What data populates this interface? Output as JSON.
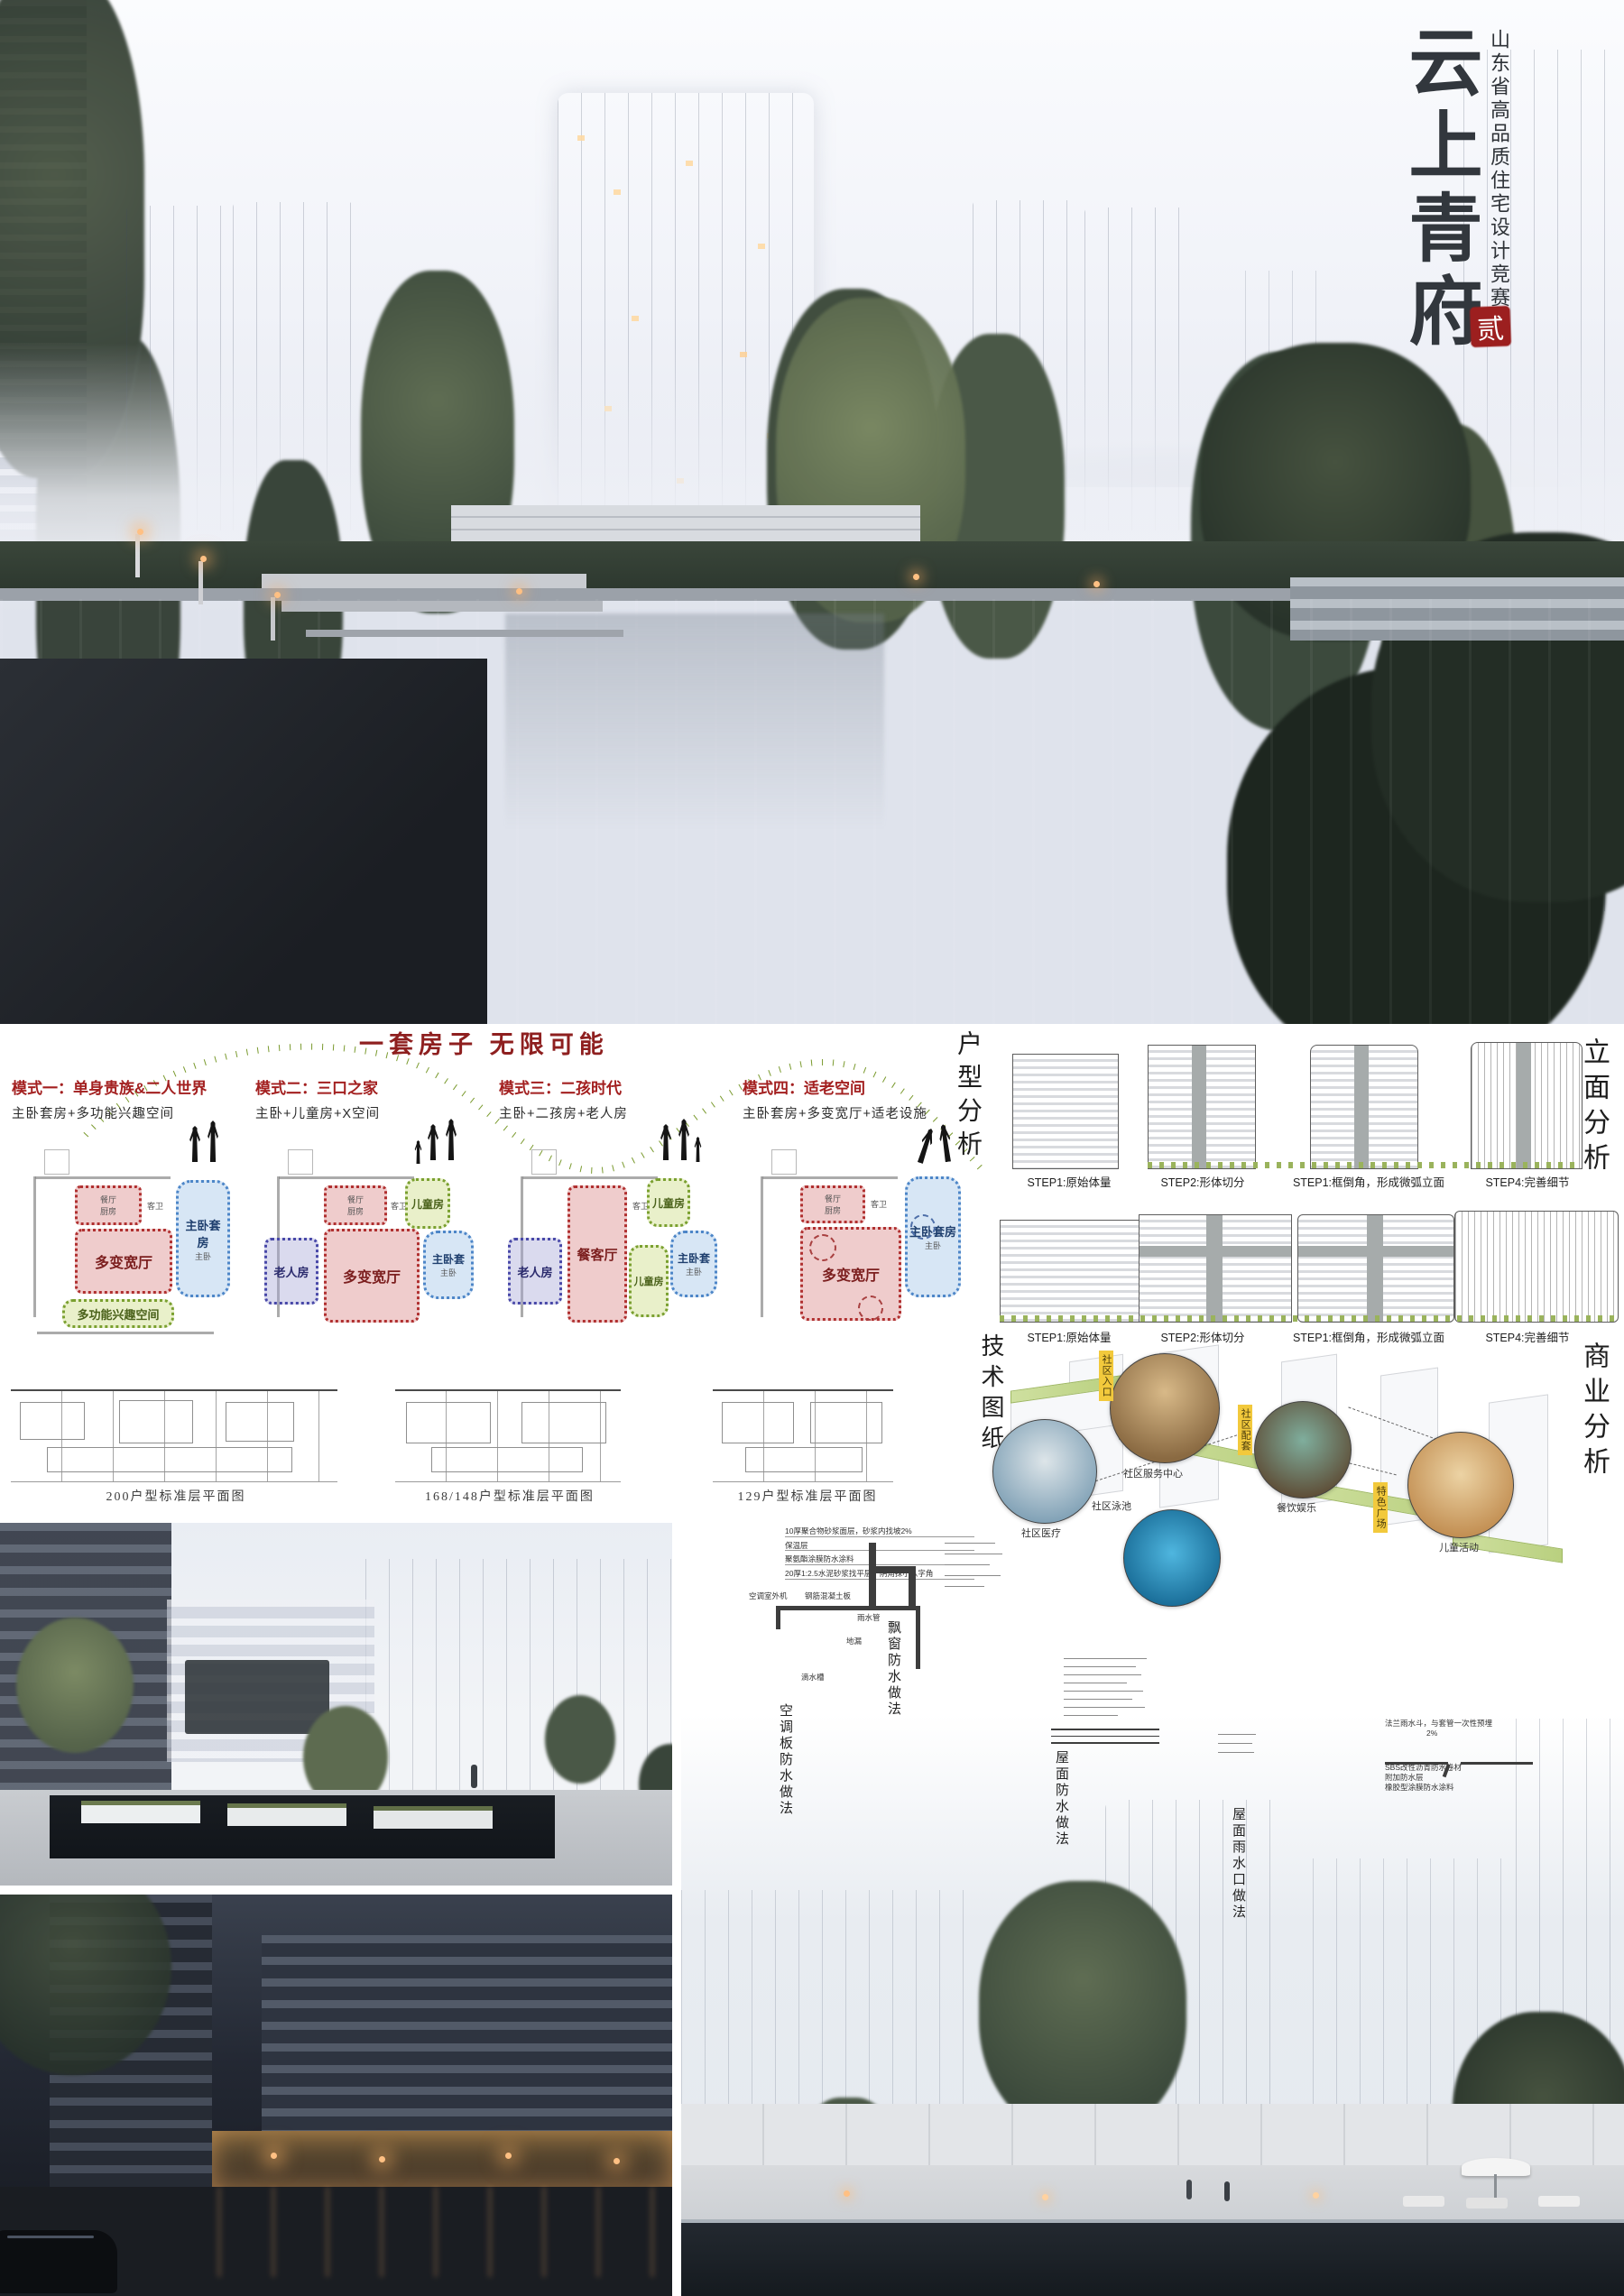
{
  "poster": {
    "title": "云上青府",
    "subtitle": "山东省高品质住宅设计竞赛",
    "seal": "贰"
  },
  "flex": {
    "heading": "一套房子 无限可能",
    "modes": [
      {
        "title": "模式一：单身贵族&二人世界",
        "formula": "主卧套房+多功能兴趣空间",
        "rooms": {
          "dining": "餐厅",
          "kitchen": "厨房",
          "bath": "客卫",
          "master": "主卧"
        },
        "regions": [
          {
            "label": "多变宽厅"
          },
          {
            "label": "主卧套房"
          },
          {
            "label": "多功能兴趣空间"
          }
        ]
      },
      {
        "title": "模式二：三口之家",
        "formula": "主卧+儿童房+X空间",
        "rooms": {
          "dining": "餐厅",
          "kitchen": "厨房",
          "bath": "客卫",
          "master": "主卧"
        },
        "regions": [
          {
            "label": "老人房"
          },
          {
            "label": "多变宽厅"
          },
          {
            "label": "儿童房"
          },
          {
            "label": "主卧套"
          }
        ]
      },
      {
        "title": "模式三：二孩时代",
        "formula": "主卧+二孩房+老人房",
        "rooms": {
          "dining": "餐厅",
          "kitchen": "厨房",
          "bath": "客卫",
          "master": "主卧"
        },
        "regions": [
          {
            "label": "老人房"
          },
          {
            "label": "餐客厅"
          },
          {
            "label": "儿童房"
          },
          {
            "label": "儿童房"
          },
          {
            "label": "主卧套"
          }
        ]
      },
      {
        "title": "模式四：适老空间",
        "formula": "主卧套房+多变宽厅+适老设施",
        "rooms": {
          "dining": "餐厅",
          "kitchen": "厨房",
          "bath": "客卫",
          "master": "主卧"
        },
        "regions": [
          {
            "label": "多变宽厅"
          },
          {
            "label": "主卧套房"
          }
        ]
      }
    ],
    "plan_captions": [
      "200户型标准层平面图",
      "168/148户型标准层平面图",
      "129户型标准层平面图"
    ]
  },
  "unit_analysis": {
    "label": "户型分析"
  },
  "facade_analysis": {
    "label": "立面分析",
    "steps": [
      "STEP1:原始体量",
      "STEP2:形体切分",
      "STEP1:框倒角，形成微弧立面",
      "STEP4:完善细节"
    ]
  },
  "commercial": {
    "label": "商业分析",
    "tags": [
      "社区入口",
      "社区配套",
      "特色广场"
    ],
    "spots": [
      "社区服务中心",
      "社区医疗",
      "社区泳池",
      "餐饮娱乐",
      "儿童活动"
    ]
  },
  "technical": {
    "label": "技术图纸",
    "details": [
      "空调板防水做法",
      "飘窗防水做法",
      "屋面防水做法",
      "屋面雨水口做法"
    ],
    "ac_notes": [
      "10厚聚合物砂浆面层，砂浆内找坡2%",
      "保温层",
      "聚氨酯涂膜防水涂料",
      "20厚1:2.5水泥砂浆找平层，阴角抹小八字角"
    ],
    "ac_parts": [
      "空调室外机",
      "钢筋混凝土板",
      "雨水管",
      "地漏",
      "滴水槽"
    ],
    "drain_notes": [
      "法兰雨水斗，与套管一次性预埋",
      "2%",
      "SBS改性沥青防水卷材",
      "附加防水层",
      "橡胶型涂膜防水涂料"
    ]
  },
  "colors": {
    "accent_red": "#8e1f1f",
    "seal_red": "#9c1f1f",
    "dot_green": "#7a9a2e",
    "tag_yellow": "#f2c93c",
    "region_red": "#b03030",
    "region_blue": "#4d86c8",
    "region_green": "#7aa030",
    "region_purple": "#4848a8"
  }
}
